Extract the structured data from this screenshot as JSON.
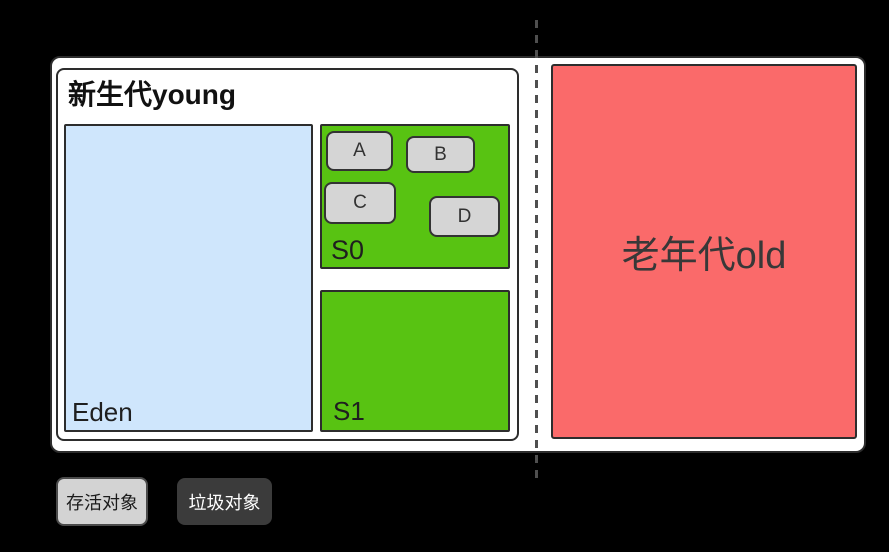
{
  "background_color": "#000000",
  "heap": {
    "young": {
      "title": "新生代young",
      "fill": "#ffffff",
      "border_color": "#2d2d2d",
      "eden": {
        "label": "Eden",
        "fill": "#cfe6fc"
      },
      "s0": {
        "label": "S0",
        "fill": "#58c312",
        "objects": [
          {
            "label": "A",
            "fill": "#d5d5d5"
          },
          {
            "label": "B",
            "fill": "#d5d5d5"
          },
          {
            "label": "C",
            "fill": "#d5d5d5"
          },
          {
            "label": "D",
            "fill": "#d5d5d5"
          }
        ]
      },
      "s1": {
        "label": "S1",
        "fill": "#58c312"
      }
    },
    "old": {
      "label": "老年代old",
      "fill": "#fa6a6a",
      "text_color": "#383838"
    },
    "divider_color": "#4f4f4f"
  },
  "legend": {
    "live": {
      "label": "存活对象",
      "fill": "#d3d3d3",
      "text_color": "#1b1b1b"
    },
    "garbage": {
      "label": "垃圾对象",
      "fill": "#3b3b3b",
      "text_color": "#ffffff"
    }
  }
}
